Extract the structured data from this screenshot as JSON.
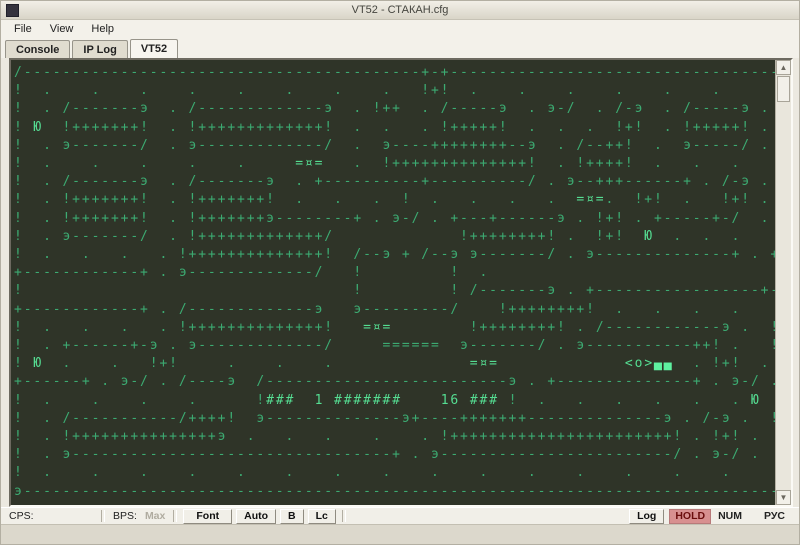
{
  "window": {
    "title": "VT52 - СТАКАН.cfg"
  },
  "menu": {
    "items": [
      "File",
      "View",
      "Help"
    ]
  },
  "tabs": [
    {
      "label": "Console",
      "active": false
    },
    {
      "label": "IP Log",
      "active": false
    },
    {
      "label": "VT52",
      "active": true
    }
  ],
  "terminal": {
    "colors": {
      "background": "#2f3428",
      "text": "#3cab72",
      "bright": "#55dd92",
      "cursor": "#5ef0a0"
    },
    "objects": {
      "player_tank": "=¤=",
      "enemy": "<o>",
      "item": "Ю",
      "score_line": "!###  1 #######    16 ###!"
    },
    "rows": [
      "/-----------------------------------------+-+----------------------------------э",
      "!  .    .    .    .    .    .    .    .   !+!  .    .    .    .    .    .      !",
      "!  . /-------э  . /-------------э  . !++  . /-----э  . э-/  . /-э  . /-----э . !",
      "! Ю  !+++++++!  . !+++++++++++++!  .  .   . !+++++!  .  .  .  !+!  . !+++++! . !",
      "!  . э-------/  . э-------------/  .  э----++++++++--э  . /--++!  .  э-----/ . !",
      "!  .    .    .    .    .     =¤=   .  !++++++++++++++!  . !++++!  .   .   .    !",
      "!  . /-------э  . /-------э  . +----------+----------/ . э--+++------+ . /-э . !",
      "!  . !+++++++!  . !+++++++!  .   .   .  !  .   .   .   .  =¤=.  !+!  .   !+! . !",
      "!  . !+++++++!  . !+++++++э--------+ . э-/ . +---+------э . !+! . +-----+-/  . !",
      "!  . э-------/  . !+++++++++++++/             !++++++++! .  !+!  Ю  .  .  .    !",
      "!  .   .   .   . !++++++++++++++!  /--э + /--э э-------/ . э--------------+ . +-",
      "+------------+ . э-------------/   !         !  .                              ",
      "!                                  !         ! /-------э . +-----------------+--",
      "+------------+ . /-------------э   э---------/    !++++++++!  .   .   .   .    !",
      "!  .   .   .   . !++++++++++++++!   =¤=        !++++++++! . /------------э .  !",
      "!  . +------+-э . э-------------/     ======  э-------/ . э-----------++! .   !",
      "! Ю  .    .   !+!     .    .    .              =¤=             <o>▄▄  . !+!  . !",
      "+------+ . э-/ . /----э  /-------------------------э . +--------------+ . э-/ .!",
      "!  .    .    .    .      !###  1 #######    16 ### !  .   .   .   .   .   . Ю  !",
      "!  . /-----------/++++!  э--------------э+----+++++++--------------э . /-э .  !",
      "!  . !+++++++++++++++э  .   .   .    .    . !+++++++++++++++++++++++! . !+! .  !",
      "!  . э---------------------------------+ . э------------------------/ . э-/ .  !",
      "!  .    .    .    .    .    .    .    .    .    .    .    .    .    .    .     !",
      "э------------------------------------------------------------------------------/"
    ]
  },
  "status": {
    "cps_label": "CPS:",
    "bps_label": "BPS:",
    "max_label": "Max",
    "font_button": "Font",
    "auto_button": "Auto",
    "b_button": "B",
    "lc_button": "Lc",
    "log_button": "Log",
    "hold_indicator": "HOLD",
    "num_indicator": "NUM",
    "rus_indicator": "РУС"
  }
}
